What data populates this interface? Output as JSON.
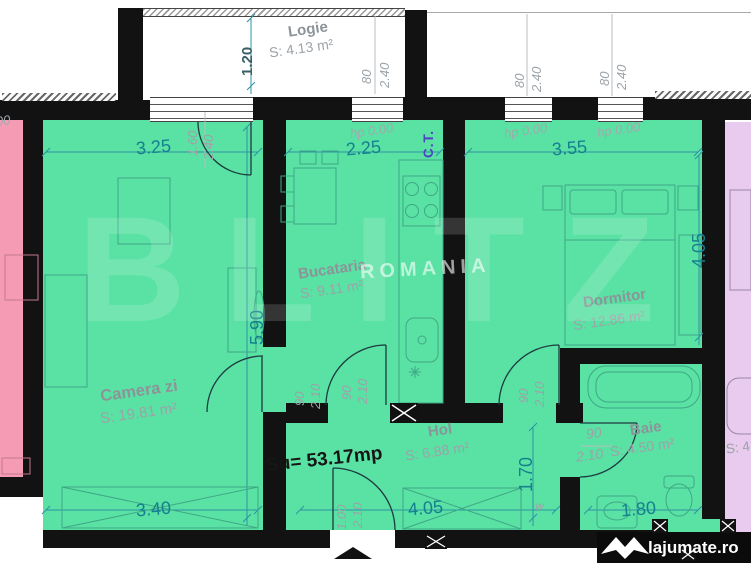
{
  "rooms": {
    "logie": {
      "name": "Logie",
      "area": "S: 4.13 m²"
    },
    "camera_zi": {
      "name": "Camera zi",
      "area": "S: 19.81 m²"
    },
    "bucatarie": {
      "name": "Bucataria",
      "area": "S: 9.11 m²"
    },
    "dormitor": {
      "name": "Dormitor",
      "area": "S: 12.86 m²"
    },
    "hol": {
      "name": "Hol",
      "area": "S: 6.88 m²"
    },
    "baie": {
      "name": "Baie",
      "area": "S: 4.50 m²"
    },
    "neighbor_right_partial": "S: 4"
  },
  "total_area": "Su= 53.17mp",
  "dims": {
    "logie_depth": "1.20",
    "camera_top": "3.25",
    "bucatarie_top": "2.25",
    "dormitor_top": "3.55",
    "camera_side": "5.90",
    "dormitor_side": "4.05",
    "camera_bottom": "3.40",
    "hol_bottom": "4.05",
    "baie_bottom": "1.80",
    "hol_side": "1.70"
  },
  "openings": {
    "balcony_door": {
      "w": "1.60",
      "h": "2.40"
    },
    "bucatarie_window": {
      "w": "80",
      "h": "2.40"
    },
    "dormitor_window_1": {
      "w": "80",
      "h": "2.40"
    },
    "dormitor_window_2": {
      "w": "80",
      "h": "2.40"
    },
    "camera_door": {
      "w": "90",
      "h": "2.10"
    },
    "bucatarie_door": {
      "w": "90",
      "h": "2.10"
    },
    "dormitor_door": {
      "w": "90",
      "h": "2.10"
    },
    "baie_door": {
      "w": "90",
      "h": "2.10"
    },
    "entrance_door": {
      "w": "1.00",
      "h": "2.10"
    }
  },
  "annotations": {
    "hp_1": "hp 0.00",
    "hp_2": "hp 0.00",
    "hp_3": "hp 0.00",
    "hp_partial": "00",
    "boiler": "C.T.",
    "washer": "w"
  },
  "watermark": {
    "big": "BLITZ",
    "small": "ROMANIA"
  },
  "branding": {
    "site": "lajumate.ro"
  },
  "colors": {
    "apartment_fill": "#5AE1A4",
    "neighbor_left_fill": "#F59BB4",
    "neighbor_right_fill": "#E8CBEE",
    "dimension_text": "#15808F",
    "wall": "#121212"
  }
}
